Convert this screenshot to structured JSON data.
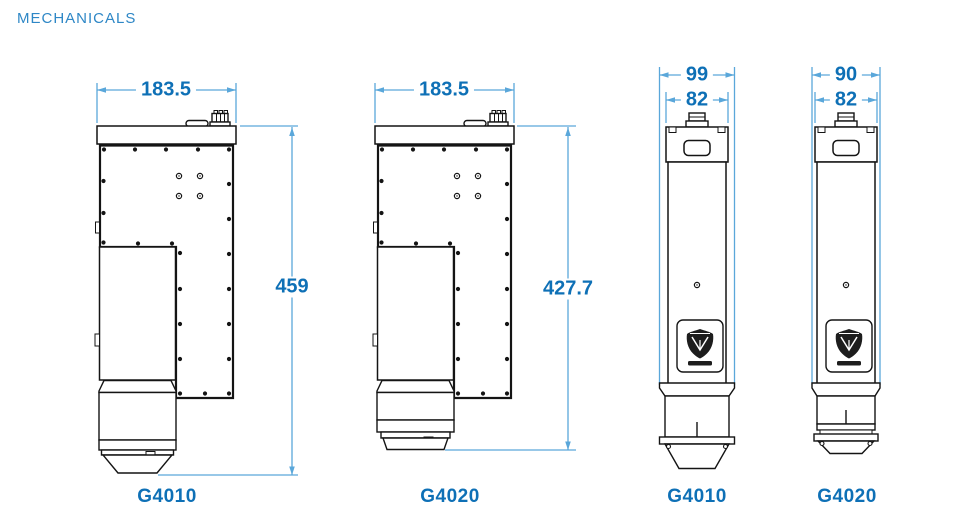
{
  "page": {
    "title": "MECHANICALS"
  },
  "colors": {
    "accent_text": "#0e70b6",
    "dimension_line": "#5aa7da",
    "title_text": "#2e87c6",
    "line_art": "#141414",
    "background": "#ffffff"
  },
  "figures": [
    {
      "model": "G4010",
      "view": "side",
      "dims": {
        "width": "183.5",
        "height": "459"
      }
    },
    {
      "model": "G4020",
      "view": "side",
      "dims": {
        "width": "183.5",
        "height": "427.7"
      }
    },
    {
      "model": "G4010",
      "view": "front",
      "dims": {
        "outer_width": "99",
        "body_width": "82"
      }
    },
    {
      "model": "G4020",
      "view": "front",
      "dims": {
        "outer_width": "90",
        "body_width": "82"
      }
    }
  ],
  "icons": {
    "brand_logo": "shield-cube-brand-logo"
  }
}
